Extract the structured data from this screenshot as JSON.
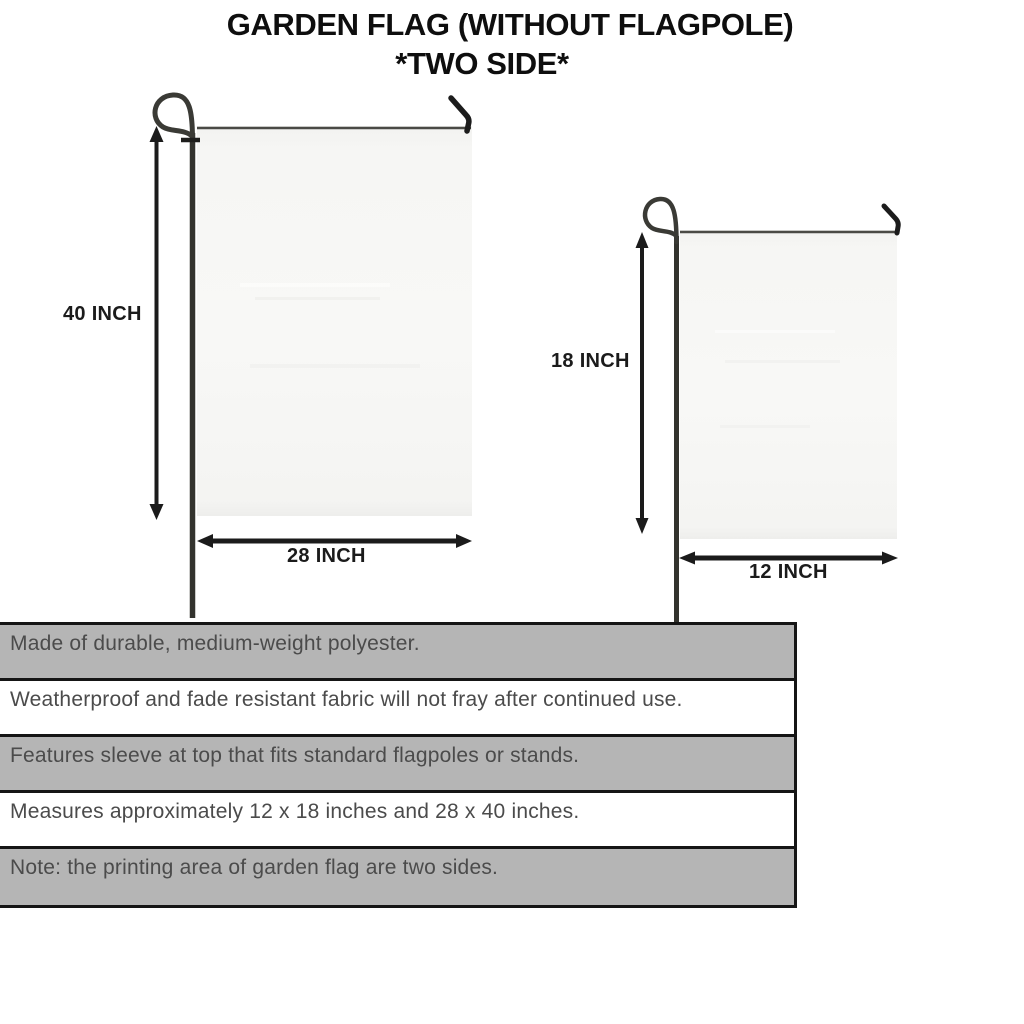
{
  "title": {
    "line1": "GARDEN FLAG (WITHOUT FLAGPOLE)",
    "line2": "*TWO SIDE*"
  },
  "diagrams": {
    "large_flag": {
      "height_label": "40 INCH",
      "width_label": "28 INCH"
    },
    "small_flag": {
      "height_label": "18 INCH",
      "width_label": "12 INCH"
    }
  },
  "features": {
    "rows": [
      "Made of durable, medium-weight polyester.",
      "Weatherproof and fade resistant fabric will not fray after continued use.",
      "Features sleeve at top that fits standard flagpoles or stands.",
      "Measures approximately 12 x 18 inches and 28 x 40 inches.",
      "Note: the printing area of garden flag are two sides."
    ]
  },
  "colors": {
    "row_gray": "#b5b5b5",
    "row_white": "#ffffff",
    "table_border": "#151515",
    "flag_fill": "#f7f7f5",
    "pole_dark": "#33332e",
    "arrow_black": "#1b1b1b",
    "feature_text": "#4b4b4b"
  }
}
